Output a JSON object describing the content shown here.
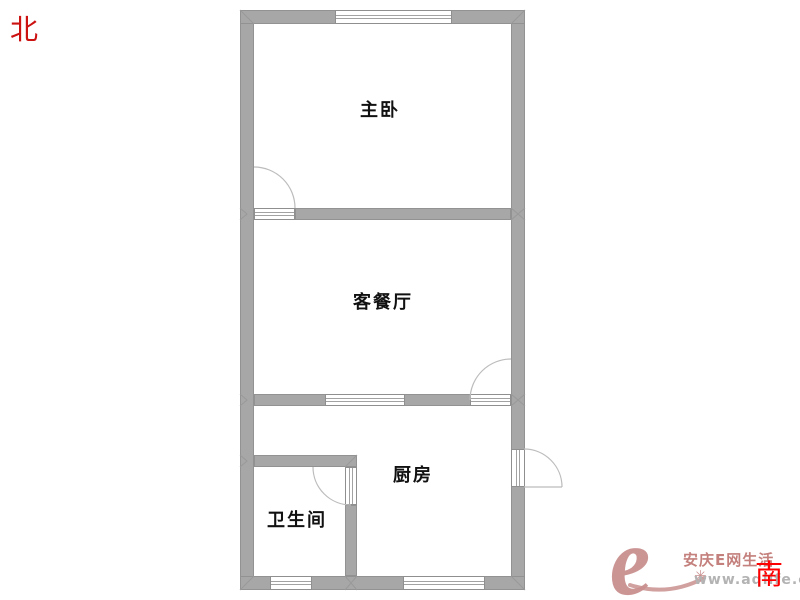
{
  "compass": {
    "north_label": "北",
    "south_label": "南"
  },
  "rooms": {
    "master_bedroom": {
      "label": "主卧"
    },
    "living_dining": {
      "label": "客餐厅"
    },
    "kitchen": {
      "label": "厨房"
    },
    "bathroom": {
      "label": "卫生间"
    }
  },
  "watermark": {
    "logo_letter": "e",
    "sparkle": "✳",
    "site_name": "安庆E网生活",
    "site_url": "www.aqlife.com"
  },
  "colors": {
    "wall": "#a7a7a7",
    "wall_edge": "#929292",
    "arc": "#bcbcbc",
    "north_red": "#cc1111",
    "south_red": "#ff0000",
    "logo_rose": "#c9908f",
    "title_rose": "#c4807c",
    "url_gray": "#b3b3b3"
  }
}
